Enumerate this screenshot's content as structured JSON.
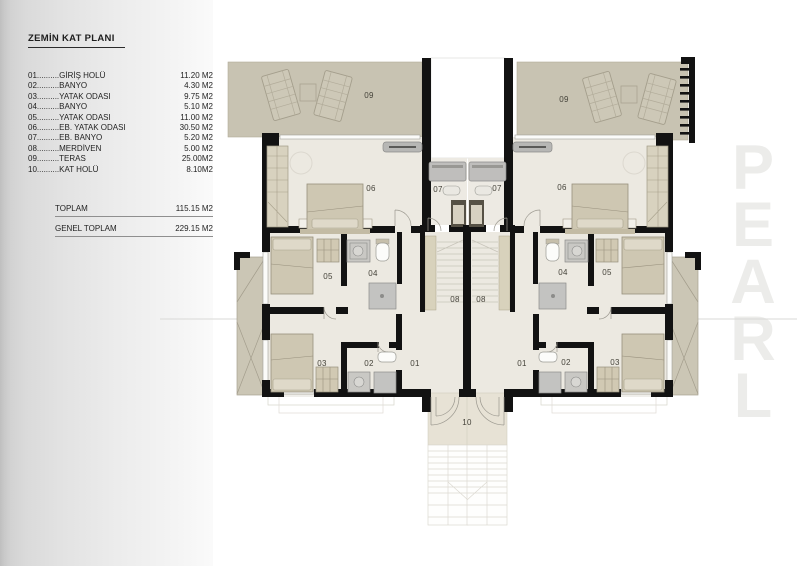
{
  "title": "ZEMİN KAT PLANI",
  "watermark": "PEARL",
  "legend": {
    "rows": [
      {
        "num": "01",
        "dots": "..........",
        "name": "GİRİŞ HOLÜ",
        "area": "11.20 M2"
      },
      {
        "num": "02",
        "dots": "..........",
        "name": "BANYO",
        "area": "4.30 M2"
      },
      {
        "num": "03",
        "dots": "..........",
        "name": "YATAK ODASI",
        "area": "9.75 M2"
      },
      {
        "num": "04",
        "dots": "..........",
        "name": "BANYO",
        "area": "5.10 M2"
      },
      {
        "num": "05",
        "dots": "..........",
        "name": "YATAK ODASI",
        "area": "11.00 M2"
      },
      {
        "num": "06",
        "dots": "..........",
        "name": "EB. YATAK ODASI",
        "area": "30.50 M2"
      },
      {
        "num": "07",
        "dots": "..........",
        "name": "EB. BANYO",
        "area": "5.20 M2"
      },
      {
        "num": "08",
        "dots": "..........",
        "name": "MERDİVEN",
        "area": "5.00 M2"
      },
      {
        "num": "09",
        "dots": "..........",
        "name": "TERAS",
        "area": "25.00M2"
      },
      {
        "num": "10",
        "dots": "..........",
        "name": "KAT HOLÜ",
        "area": "8.10M2"
      }
    ],
    "totals": [
      {
        "label": "TOPLAM",
        "value": "115.15 M2"
      },
      {
        "label": "GENEL TOPLAM",
        "value": "229.15 M2"
      }
    ]
  },
  "plan": {
    "room_labels": {
      "terrace_left": "09",
      "terrace_right": "09",
      "master_left": "06",
      "master_right": "06",
      "bath7_left": "07",
      "bath7_right": "07",
      "bed5_left": "05",
      "bed5_right": "05",
      "bath4_left": "04",
      "bath4_right": "04",
      "stairs_left": "08",
      "stairs_right": "08",
      "bed3_left": "03",
      "bed3_right": "03",
      "bath2_left": "02",
      "bath2_right": "02",
      "hall1_left": "01",
      "hall1_right": "01",
      "hall10": "10"
    },
    "colors": {
      "wall": "#121212",
      "terrace": "#c8c3b2",
      "floor": "#ece9e1",
      "furniture": "#cec7b2",
      "fixture": "#c3c3c1",
      "hall10": "#e7e2d5"
    }
  }
}
